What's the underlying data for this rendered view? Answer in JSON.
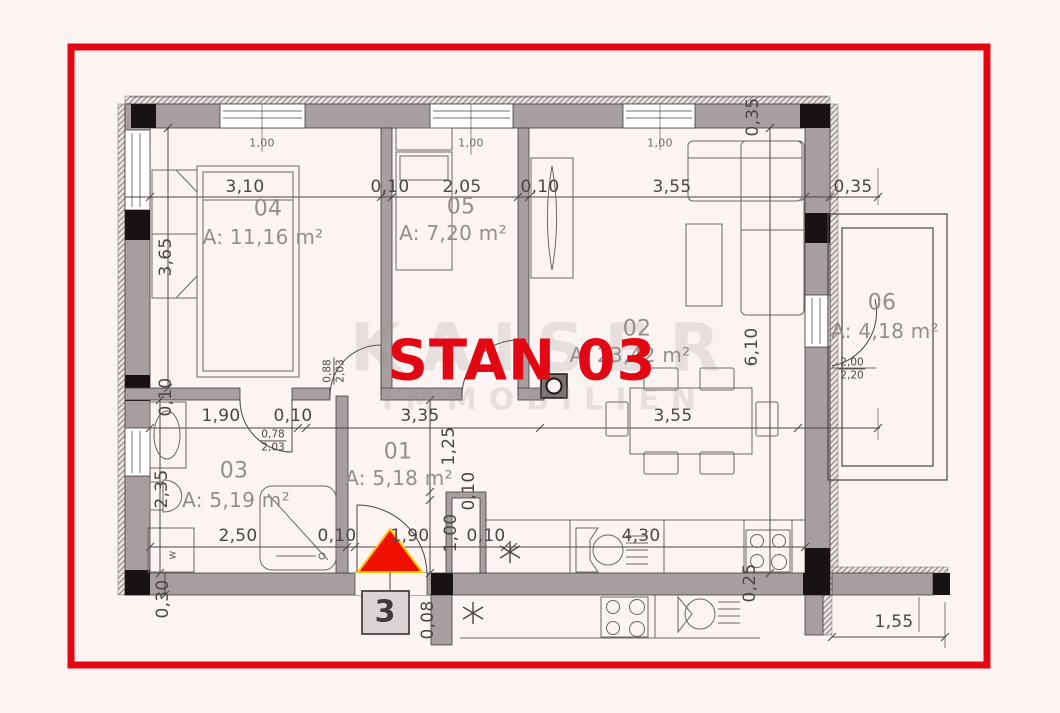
{
  "title": "STAN 03",
  "watermark": {
    "line1": "KAISER",
    "line2": "IMMOBILIEN"
  },
  "entrance": {
    "unit_number": "3"
  },
  "rooms": {
    "r01": {
      "id": "01",
      "area": "A: 5,18 m²"
    },
    "r02": {
      "id": "02",
      "area": "A: 23,42 m²"
    },
    "r03": {
      "id": "03",
      "area": "A: 5,19 m²"
    },
    "r04": {
      "id": "04",
      "area": "A: 11,16 m²"
    },
    "r05": {
      "id": "05",
      "area": "A: 7,20 m²"
    },
    "r06": {
      "id": "06",
      "area": "A: 4,18 m²"
    }
  },
  "dims": {
    "top": [
      "3,10",
      "0,10",
      "2,05",
      "0,10",
      "3,55",
      "0,35"
    ],
    "top_right_vertical": "0,35",
    "window_widths": [
      "1,00",
      "1,00",
      "1,00"
    ],
    "left_vertical": [
      "3,65",
      "0,10",
      "2,35",
      "0,30"
    ],
    "middle_row": [
      "1,90",
      "0,10",
      "3,35",
      "3,55"
    ],
    "middle_vertical": [
      "1,25",
      "0,10",
      "1,00",
      "0,08"
    ],
    "right_vertical": [
      "6,10",
      "0,25"
    ],
    "bottom_row": [
      "2,50",
      "0,10",
      "1,90",
      "0,10",
      "4,30"
    ],
    "bottom_right": "1,55",
    "door_04": {
      "w": "0,88",
      "h": "2,03"
    },
    "door_03": {
      "w": "0,78",
      "h": "2,03"
    },
    "door_06": {
      "w": "2,00",
      "h": "2,20"
    },
    "washer_mark": "w"
  }
}
